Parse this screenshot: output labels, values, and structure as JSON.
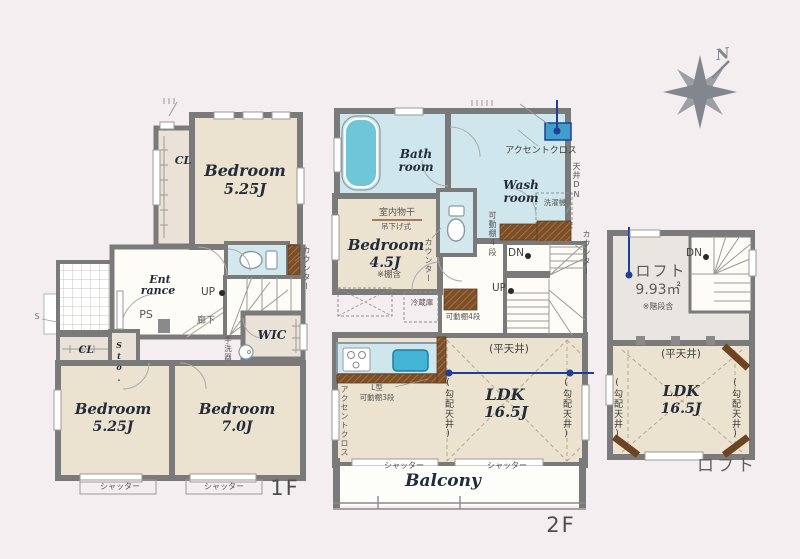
{
  "colors": {
    "background": "#f5eef1",
    "wall": "#7a7a7a",
    "floor_cream": "#ebe3cf",
    "water_blue": "#cfe7ec",
    "tub_blue": "#6fc6d8",
    "wood_brown": "#7d4f28",
    "accent_navy": "#1e3e9a",
    "loft_gray": "#e9e6e1"
  },
  "compass": {
    "north": "N"
  },
  "f1": {
    "label": "1F",
    "cl_top": "CL",
    "bedroom_top": {
      "name": "Bedroom",
      "area": "5.25J"
    },
    "entrance1": "Ent",
    "entrance2": "rance",
    "ps": "PS",
    "up": "UP",
    "hallway": "廊下",
    "counter": "カウンター",
    "handwash": "手洗器",
    "wic": "WIC",
    "cl_bottom": "CL",
    "storage": "Sto.",
    "sensor": "S",
    "bedroom_left": {
      "name": "Bedroom",
      "area": "5.25J"
    },
    "bedroom_right": {
      "name": "Bedroom",
      "area": "7.0J"
    },
    "shutter1": "シャッター",
    "shutter2": "シャッター"
  },
  "f2": {
    "label": "2F",
    "bath1": "Bath",
    "bath2": "room",
    "accent_top": "アクセントクロス",
    "wash1": "Wash",
    "wash2": "room",
    "washer": "洗濯機",
    "ceiling_dn": "天井DN",
    "counter_right": "カウンター",
    "indoor_drying": "室内物干",
    "hanging": "吊下げ式",
    "bedroom": {
      "name": "Bedroom",
      "area": "4.5J"
    },
    "shelf_note": "※棚含",
    "counter_mid": "カウンター",
    "shelf4_v": "可動棚4段",
    "dn": "DN",
    "up": "UP",
    "fridge": "冷蔵庫",
    "shelf4_h": "可動棚4段",
    "l_shape": "L型",
    "shelf3": "可動棚3段",
    "accent_left": "アクセントクロス",
    "flat_ceiling": "(平天井)",
    "ldk": {
      "name": "LDK",
      "area": "16.5J"
    },
    "sloped_l": "(勾配天井)",
    "sloped_r": "(勾配天井)",
    "shutter1": "シャッター",
    "shutter2": "シャッター",
    "balcony": "Balcony"
  },
  "loft": {
    "label": "ロフト",
    "dn": "DN",
    "title": "ロフト",
    "area": "9.93㎡",
    "stairs_note": "※階段含",
    "flat_ceiling": "(平天井)",
    "ldk": {
      "name": "LDK",
      "area": "16.5J"
    },
    "sloped_l": "(勾配天井)",
    "sloped_r": "(勾配天井)"
  }
}
